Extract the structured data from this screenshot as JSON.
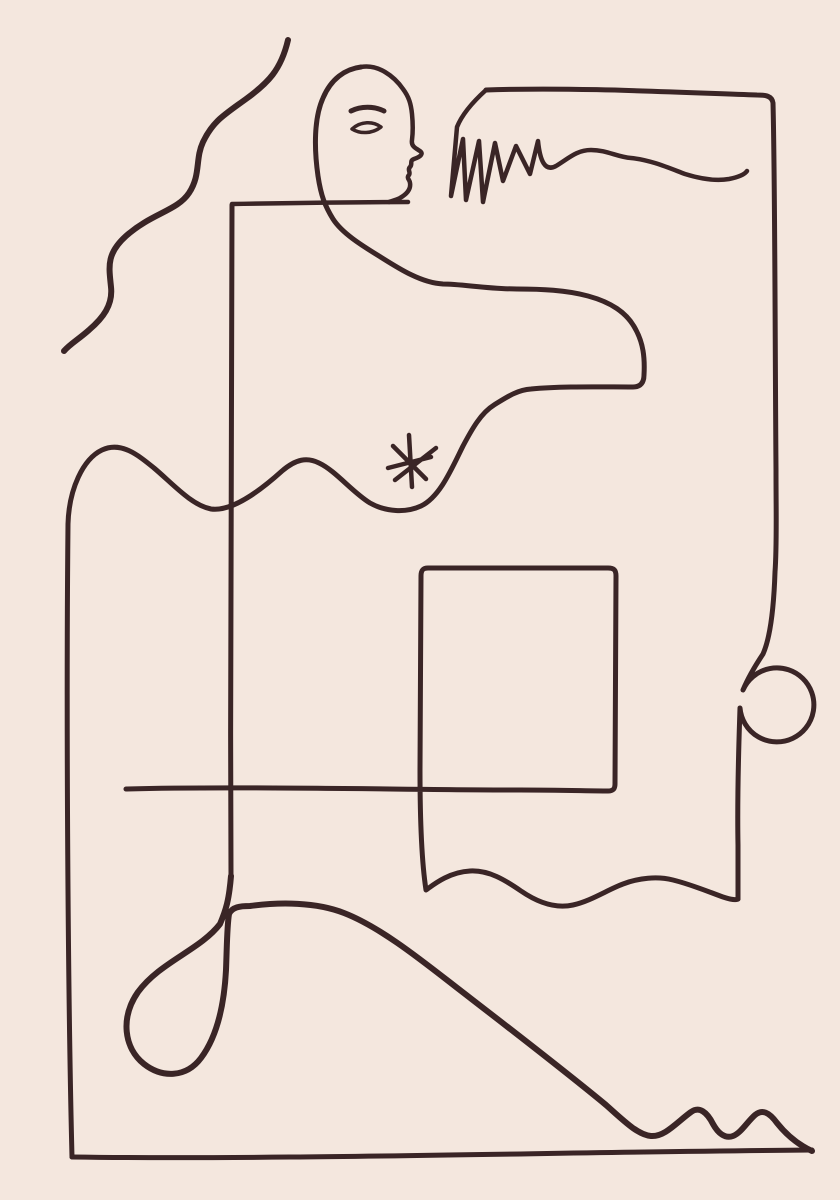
{
  "artwork": {
    "title": "abstract-one-line-figure-drawing",
    "background_color": "#f4e7de",
    "line_color": "#3a2526",
    "strokes": [
      {
        "name": "hair-wave-line",
        "width": 6,
        "d": "M288,40 C281,70 268,83 246,99 C224,115 213,121 203,142 C195,159 201,175 189,193 C177,211 152,213 126,236 C106,254 109,267 111,287 C113,305 103,318 89,330 C79,339 70,344 64,351"
      },
      {
        "name": "under-chin-line",
        "width": 4.5,
        "d": "M232,204 C290,203 350,202 408,202"
      },
      {
        "name": "torso-vertical-line",
        "width": 5,
        "d": "M232,205 C231,420 230,650 231,876"
      },
      {
        "name": "bottom-loop-and-slope-line",
        "width": 6,
        "d": "M231,876 C229,900 226,910 220,924 C200,950 160,962 138,992 C120,1018 124,1048 144,1064 C162,1078 186,1078 201,1058 C216,1038 224,1008 226,970 C227,944 227,926 229,914 C232,907 240,906 250,906 C280,902 316,902 344,913 C380,927 420,959 456,987 C500,1021 560,1067 606,1105 C624,1121 638,1135 651,1136 C665,1137 677,1122 691,1112 C699,1106 707,1112 713,1124 C718,1133 725,1139 733,1136 C741,1133 747,1122 755,1115 C762,1109 769,1112 777,1123 C789,1138 801,1146 812,1151"
      },
      {
        "name": "baseline",
        "width": 5,
        "d": "M72,1157 C280,1160 560,1152 812,1150"
      },
      {
        "name": "figure-contour-line",
        "width": 5,
        "d": "M72,1157 C68,1000 66,720 68,524 C69,489 83,459 102,450 C121,441 138,455 154,468 C172,483 191,505 211,509 C233,512 262,489 282,471 C296,459 307,457 319,463 C336,471 352,492 370,503 C386,512 406,513 421,506 C440,497 452,468 463,446 C472,429 481,413 494,405 C507,397 517,390 531,389 C561,386 601,387 633,387 C641,387 644,382 644,375 C645,357 643,343 636,330 C627,312 610,302 588,296 C566,290 541,289 517,289 C489,289 461,284 443,284 C421,283 398,268 379,256 C361,245 342,233 333,219 C325,206 321,196 318,176 C314,148 314,118 323,98 C331,79 345,69 361,67"
      },
      {
        "name": "face-profile-line",
        "width": 4.5,
        "d": "M361,67 C378,64 394,76 403,89 C409,97 411,104 412,114 C413,124 413,132 412,140 C411,146 415,148 420,151 C424,154 420,157 414,159 C409,161 413,164 410,167 C407,170 411,172 409,175 C406,178 410,180 410,183 C411,189 407,194 400,198 C396,200 392,201 389,202"
      },
      {
        "name": "eyebrow-line",
        "width": 5,
        "d": "M351,111 C361,106 374,106 384,111"
      },
      {
        "name": "eye-outline",
        "width": 3.5,
        "d": "M352,129 C361,121 373,121 381,127 C372,134 360,134 352,129 Z"
      },
      {
        "name": "hand-fingers-line",
        "width": 4.5,
        "d": "M486,90 C476,99 463,112 457,127 L451,196 L463,139 L466,200 L479,141 L483,202 L495,143 L503,181 L516,146 L530,174 L538,141 C540,161 545,172 556,166 C569,158 577,150 591,150 C607,150 617,157 631,158 C651,160 669,168 685,174 C701,179 717,181 729,179 C739,177 745,174 747,171"
      },
      {
        "name": "top-frame-and-right-loop-line",
        "width": 5,
        "d": "M486,90 C570,87 670,92 757,95 C766,95 772,96 773,103 C775,180 775,340 776,470 C776,515 777,545 775,572 C774,602 771,636 763,654 C755,666 748,678 743,690 A37,37 0 1 1 740,708 C739,740 737,790 738,845 C738,870 738,888 738,899"
      },
      {
        "name": "rectangle-line",
        "width": 5,
        "d": "M126,789 C240,786 420,790 520,790 C560,790 590,791 608,791 C613,791 615,789 615,784 L616,576 C616,570 614,568 608,568 L428,568 C423,568 421,570 421,576 L420,770 C420,820 422,864 426,890 C433,885 449,872 470,871 C489,870 505,880 521,891 C537,902 555,909 573,905 C591,901 607,890 623,884 C639,878 657,876 673,880 C693,885 709,892 723,897 C732,900 737,900 738,899"
      },
      {
        "name": "asterisk-star",
        "width": 4.5,
        "d": "M409,435 L412,487 M388,468 L431,457 M393,446 L426,479 M395,480 L436,448"
      }
    ]
  }
}
